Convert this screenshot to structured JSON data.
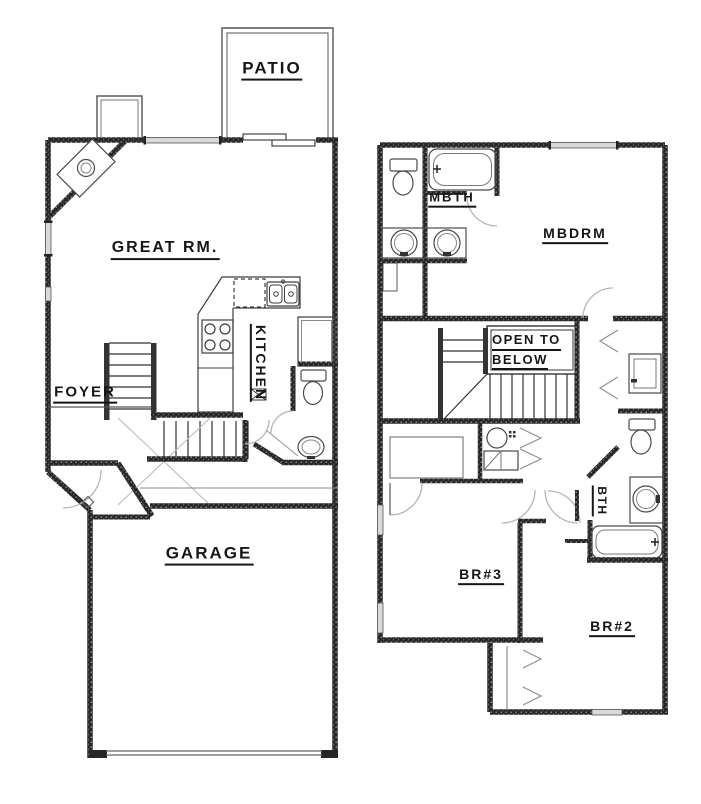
{
  "drawing": {
    "type": "two-story residential floor plan",
    "colors": {
      "wall_ink": "#262626",
      "fixture_line": "#4a4a4a",
      "swing_line": "#b5b5b5",
      "window_fill": "#d9d9d9",
      "text": "#161616",
      "paper": "#ffffff"
    },
    "floor1": {
      "labels": {
        "patio": "PATIO",
        "great_rm": "GREAT RM.",
        "kitchen": "KITCHEN",
        "foyer": "FOYER",
        "garage": "GARAGE"
      }
    },
    "floor2": {
      "labels": {
        "mbth": "MBTH",
        "mbdrm": "MBDRM",
        "open_to": "OPEN TO",
        "below": "BELOW",
        "br3": "BR#3",
        "bth": "BTH",
        "br2": "BR#2"
      }
    }
  }
}
